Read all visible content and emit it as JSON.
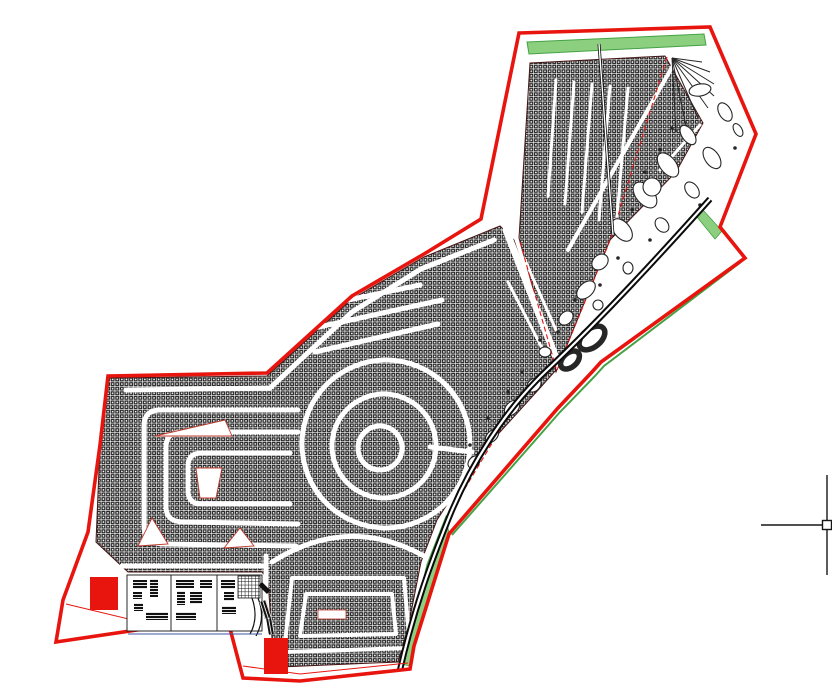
{
  "canvas": {
    "type": "cad-drawing-viewport",
    "background": "#ffffff"
  },
  "colors": {
    "boundary_red": "#e8150f",
    "hatch_dark": "#262626",
    "mass_edge": "#471414",
    "green_fill": "#8ccf7f",
    "green_line": "#44a244",
    "road_black": "#0b0b0b",
    "blue_line": "#3a55a4",
    "cursor_black": "#161616",
    "street_red": "#c0392b"
  },
  "cursor": {
    "transform": "translate(827,525)",
    "pickbox_px": 9,
    "arm_px": 66
  }
}
